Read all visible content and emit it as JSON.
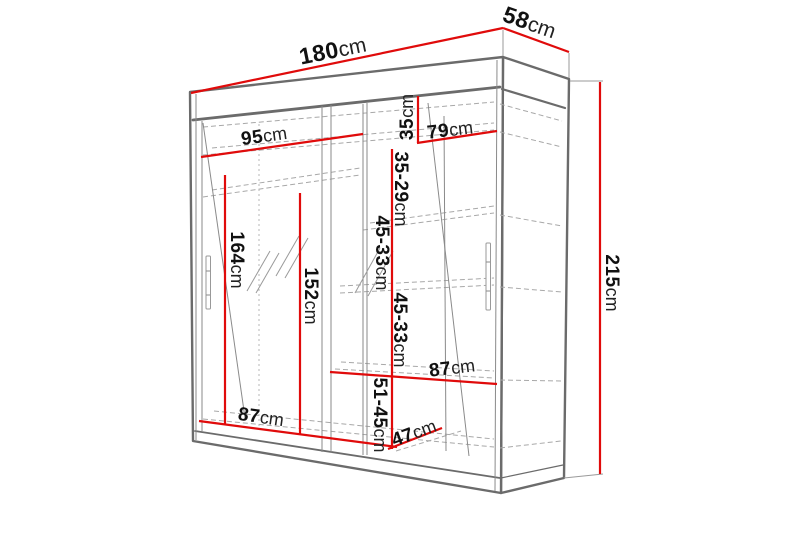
{
  "diagram": {
    "unit": "cm",
    "colors": {
      "dimension_line": "#e00b0b",
      "outline": "#6b6b6b",
      "hidden_line": "#a8a8a8",
      "label_text": "#111111"
    }
  },
  "dims": {
    "width": {
      "num": "180",
      "unit": "cm"
    },
    "depth": {
      "num": "58",
      "unit": "cm"
    },
    "height": {
      "num": "215",
      "unit": "cm"
    },
    "left_section_width": {
      "num": "95",
      "unit": "cm"
    },
    "right_section_width": {
      "num": "79",
      "unit": "cm"
    },
    "top_shelf_gap": {
      "num": "35",
      "unit": "cm"
    },
    "second_shelf_gap": {
      "num": "35-29",
      "unit": "cm"
    },
    "mirror_door_height": {
      "num": "164",
      "unit": "cm"
    },
    "hanging_height": {
      "num": "152",
      "unit": "cm"
    },
    "middle_shelf_gap": {
      "num": "45-33",
      "unit": "cm"
    },
    "lower_shelf_gap": {
      "num": "45-33",
      "unit": "cm"
    },
    "right_shelf_width": {
      "num": "87",
      "unit": "cm"
    },
    "bottom_section_width": {
      "num": "87",
      "unit": "cm"
    },
    "bottom_depth": {
      "num": "47",
      "unit": "cm"
    },
    "bottom_shelf_gap": {
      "num": "51-45",
      "unit": "cm"
    }
  }
}
